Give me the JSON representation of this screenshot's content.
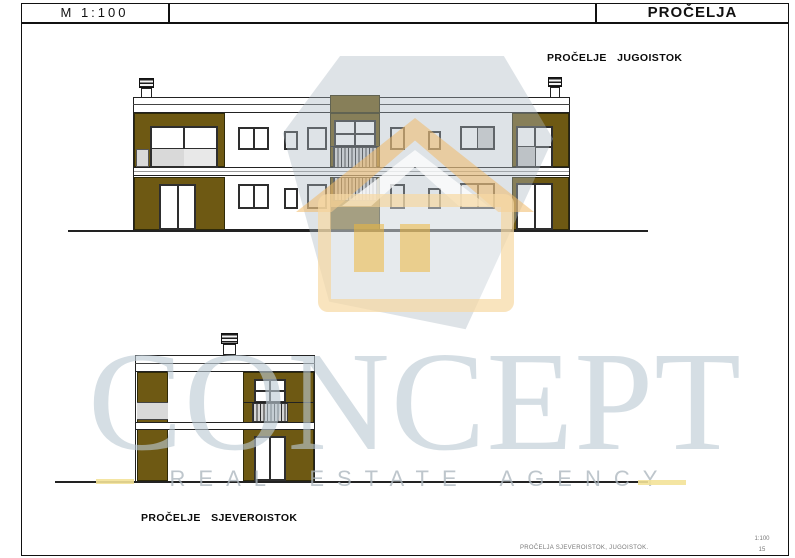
{
  "header": {
    "scale_label": "M 1:100",
    "sheet_title": "PROČELJA"
  },
  "drawings": {
    "southeast": {
      "label": "PROČELJE JUGOISTOK"
    },
    "northeast": {
      "label": "PROČELJE SJEVEROISTOK"
    }
  },
  "watermark": {
    "brand": "CONCEPT",
    "tagline": "REAL ESTATE AGENCY"
  },
  "footer": {
    "sheet_name": "PROČELJA SJEVEROISTOK, JUGOISTOK.",
    "scale": "1:100",
    "page_number": "15"
  },
  "colors": {
    "wall_olive": "#6e5913",
    "glass_gray": "#d9d9d9",
    "drawing_line": "#222222",
    "watermark_gray": "#bcc9d1",
    "watermark_orange": "#f0ba68",
    "watermark_gold": "#ecb63e",
    "accent_dash": "#f3e298"
  }
}
